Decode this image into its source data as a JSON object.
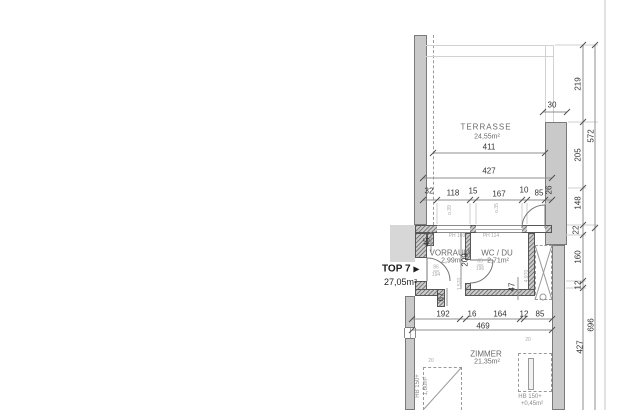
{
  "unit": {
    "label": "TOP 7",
    "arrow": "▶",
    "area": "27,05m²"
  },
  "rooms": {
    "terrasse": {
      "name": "TERRASSE",
      "area": "24,55m²"
    },
    "vorraum": {
      "name": "VORRAUM",
      "area": "2,99m²"
    },
    "wc": {
      "name": "WC / DU",
      "area": "2,71m²"
    },
    "zimmer": {
      "name": "ZIMMER",
      "area": "21,35m²"
    }
  },
  "dims": {
    "terrace_width": "411",
    "terrace_width_outer": "427",
    "top_row": [
      "32",
      "118",
      "15",
      "167",
      "10",
      "85",
      "26"
    ],
    "block": "30",
    "right_inner": [
      "219",
      "205",
      "148",
      "22",
      "160",
      "12",
      "427"
    ],
    "right_outer": [
      "572",
      "696"
    ],
    "mid_row": [
      "192",
      "16",
      "164",
      "12",
      "85"
    ],
    "mid_width": "469",
    "niche": "45",
    "vorraum_height": "209",
    "stub": "67",
    "shaft": "47"
  },
  "annotations": {
    "ph_left": "PH 103",
    "ph_right": "PH 114",
    "door_entry": {
      "w": "86",
      "h": "194"
    },
    "door_wc": {
      "w": "65",
      "h": "196"
    },
    "parapet_a": "o.39",
    "parapet_b": "o.35",
    "level_a": "1.570",
    "level_b": "4.970",
    "small_a": "20",
    "small_b": "20",
    "niche_left": {
      "l1": "HB 150+",
      "l2": "1,60m²"
    },
    "niche_right": {
      "l1": "HB 150+",
      "l2": "+0,45m²"
    }
  },
  "colors": {
    "wall_fill": "#c4c4c4",
    "wall_edge": "#565656",
    "dim_line": "#8f8f8f",
    "light_line": "#d2d2d2",
    "text": "#343434",
    "faint_text": "#a9a9a9",
    "background": "#ffffff"
  }
}
